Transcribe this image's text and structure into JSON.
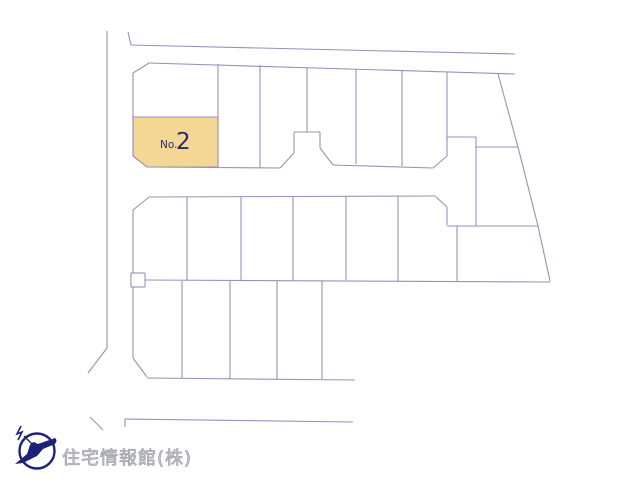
{
  "window": {
    "width": 640,
    "height": 480,
    "background": "#ffffff"
  },
  "map": {
    "stroke_color": "#9294ba",
    "stroke_width": 1.1,
    "segments": [
      [
        107,
        31,
        107,
        348
      ],
      [
        107,
        348,
        88,
        373
      ],
      [
        90,
        417,
        103,
        430
      ],
      [
        128,
        32,
        131,
        45
      ],
      [
        131,
        45,
        515,
        54
      ],
      [
        125,
        419,
        125,
        427
      ],
      [
        125,
        419,
        353,
        422
      ],
      [
        149,
        63,
        515,
        74
      ],
      [
        133,
        73,
        149,
        63
      ],
      [
        133,
        73,
        133,
        156
      ],
      [
        133,
        156,
        147,
        167
      ],
      [
        133,
        117,
        218,
        117
      ],
      [
        147,
        167,
        280,
        168
      ],
      [
        280,
        168,
        294,
        153
      ],
      [
        294,
        153,
        294,
        132
      ],
      [
        294,
        132,
        320,
        132
      ],
      [
        320,
        132,
        320,
        148
      ],
      [
        320,
        148,
        333,
        165
      ],
      [
        333,
        165,
        433,
        168
      ],
      [
        433,
        168,
        447,
        156
      ],
      [
        218,
        64,
        218,
        167
      ],
      [
        260,
        65,
        260,
        168
      ],
      [
        307,
        68,
        307,
        132
      ],
      [
        356,
        69,
        356,
        164
      ],
      [
        402,
        70,
        402,
        166
      ],
      [
        447,
        72,
        447,
        156
      ],
      [
        447,
        137,
        476,
        137
      ],
      [
        476,
        137,
        476,
        226
      ],
      [
        476,
        147,
        518,
        147
      ],
      [
        447,
        226,
        538,
        226
      ],
      [
        457,
        226,
        457,
        281
      ],
      [
        133,
        210,
        149,
        197
      ],
      [
        149,
        197,
        435,
        196
      ],
      [
        133,
        210,
        133,
        273
      ],
      [
        131,
        273,
        145,
        273
      ],
      [
        145,
        273,
        145,
        287
      ],
      [
        131,
        287,
        145,
        287
      ],
      [
        131,
        273,
        131,
        287
      ],
      [
        435,
        196,
        447,
        207
      ],
      [
        447,
        207,
        447,
        225
      ],
      [
        187,
        197,
        187,
        280
      ],
      [
        241,
        197,
        241,
        280
      ],
      [
        293,
        196,
        293,
        280
      ],
      [
        346,
        196,
        346,
        280
      ],
      [
        398,
        196,
        398,
        281
      ],
      [
        145,
        280,
        550,
        282
      ],
      [
        133,
        287,
        133,
        358
      ],
      [
        133,
        358,
        147,
        377
      ],
      [
        147,
        378,
        355,
        380
      ],
      [
        182,
        281,
        182,
        378
      ],
      [
        230,
        281,
        230,
        379
      ],
      [
        277,
        281,
        277,
        379
      ],
      [
        322,
        281,
        322,
        379
      ]
    ],
    "boundary_polyline": [
      [
        498,
        74
      ],
      [
        518,
        147
      ],
      [
        538,
        226
      ],
      [
        550,
        281
      ]
    ],
    "highlight_lot": {
      "polygon": [
        [
          133,
          117
        ],
        [
          218,
          117
        ],
        [
          218,
          167
        ],
        [
          147,
          167
        ],
        [
          133,
          156
        ]
      ],
      "fill": "#f5d795",
      "label_prefix": "No.",
      "label_number": "2",
      "label_color": "#2b2a6c"
    }
  },
  "footer": {
    "company_name": "住宅情報館(株)",
    "logo": "bird-in-circle-icon",
    "logo_color": "#1c2377",
    "text_color": "#c6c6ce"
  }
}
